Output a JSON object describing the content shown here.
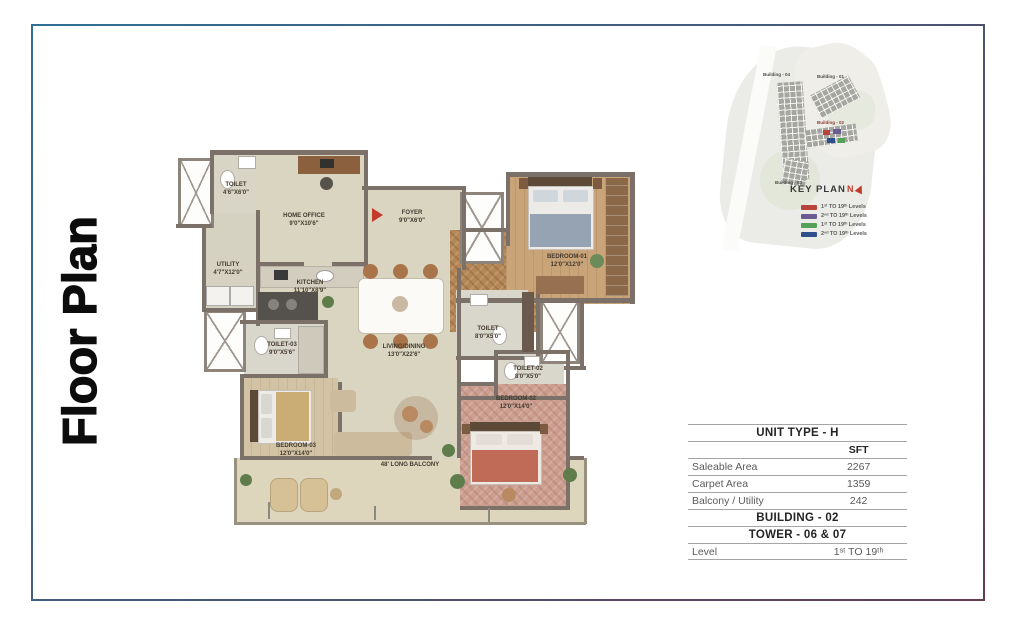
{
  "page": {
    "vertical_title": "Floor Plan"
  },
  "keyplan": {
    "title": "KEY PLAN",
    "compass": "N",
    "building_labels": [
      "Building - 04",
      "Building - 01",
      "Building - 02",
      "Building - 03"
    ],
    "legend": [
      {
        "color": "#b8433a",
        "label": "1ˢᵗ TO 19ᵗʰ Levels"
      },
      {
        "color": "#6a5b93",
        "label": "2ⁿᵈ TO 19ᵗʰ Levels"
      },
      {
        "color": "#55a158",
        "label": "1ˢᵗ TO 19ᵗʰ Levels"
      },
      {
        "color": "#2f4f8c",
        "label": "2ⁿᵈ TO 19ᵗʰ Levels"
      }
    ],
    "unit_colors": {
      "red": "#b8433a",
      "purple": "#6a5b93",
      "blue": "#2f4f8c",
      "green": "#55a158"
    }
  },
  "unit_table": {
    "title": "UNIT TYPE - H",
    "unit_header": "SFT",
    "rows": [
      {
        "label": "Saleable Area",
        "value": "2267"
      },
      {
        "label": "Carpet Area",
        "value": "1359"
      },
      {
        "label": "Balcony / Utility",
        "value": "242"
      }
    ],
    "building": "BUILDING - 02",
    "tower": "TOWER - 06 & 07",
    "level_label": "Level",
    "level_value": "1ˢᵗ TO 19ᵗʰ"
  },
  "floorplan": {
    "rooms": {
      "toilet_top": {
        "name": "TOILET",
        "dim": "4'6\"X6'0\""
      },
      "home_office": {
        "name": "HOME OFFICE",
        "dim": "9'0\"X10'6\""
      },
      "utility": {
        "name": "UTILITY",
        "dim": "4'7\"X12'0\""
      },
      "kitchen": {
        "name": "KITCHEN",
        "dim": "11'10\"X8'9\""
      },
      "foyer": {
        "name": "FOYER",
        "dim": "9'0\"X6'0\""
      },
      "bedroom1": {
        "name": "BEDROOM-01",
        "dim": "12'0\"X12'0\""
      },
      "toilet_mid": {
        "name": "TOILET",
        "dim": "8'0\"X5'0\""
      },
      "toilet2": {
        "name": "TOILET-02",
        "dim": "8'0\"X5'0\""
      },
      "toilet3": {
        "name": "TOILET-03",
        "dim": "9'0\"X5'6\""
      },
      "living": {
        "name": "LIVING/DINING",
        "dim": "13'0\"X22'6\""
      },
      "bedroom3": {
        "name": "BEDROOM-03",
        "dim": "12'0\"X14'0\""
      },
      "bedroom2": {
        "name": "BEDROOM-02",
        "dim": "12'0\"X14'0\""
      },
      "balcony": {
        "name": "48' LONG BALCONY",
        "dim": ""
      }
    }
  }
}
